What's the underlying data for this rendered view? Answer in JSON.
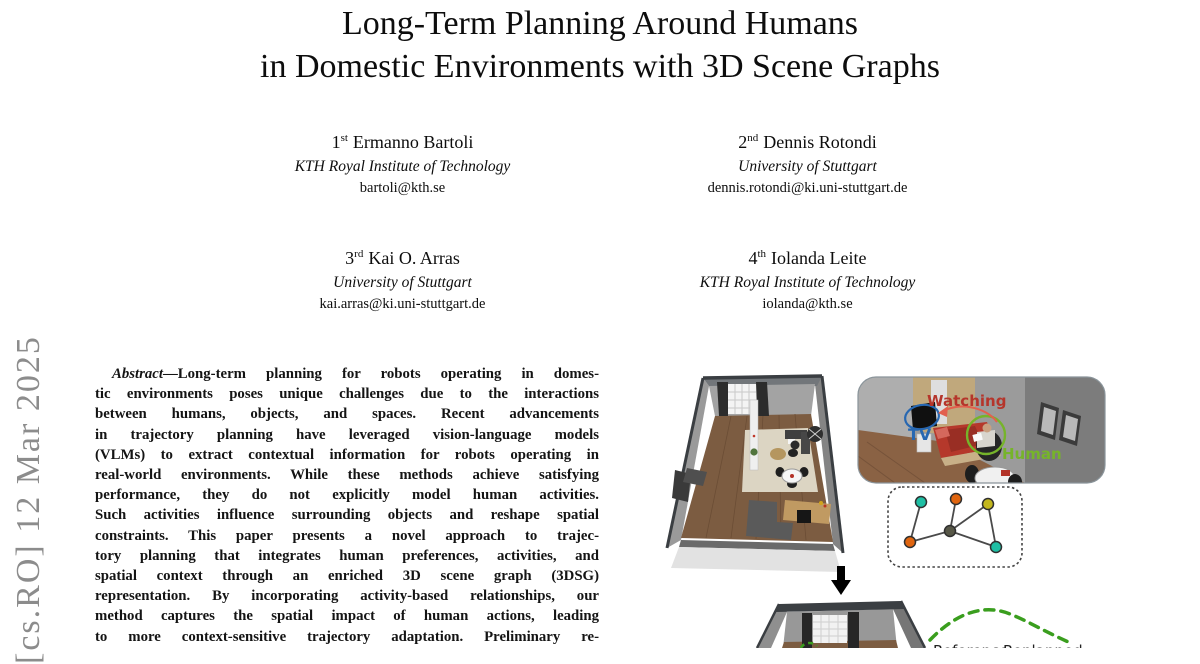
{
  "arxiv_stamp": {
    "text": "[cs.RO] 12 Mar 2025",
    "color": "#8c8c8c"
  },
  "title": {
    "line1": "Long-Term Planning Around Humans",
    "line2": "in Domestic Environments with 3D Scene Graphs"
  },
  "authors": [
    {
      "ordinal": "1",
      "suffix": "st",
      "name": "Ermanno Bartoli",
      "affiliation": "KTH Royal Institute of Technology",
      "email": "bartoli@kth.se"
    },
    {
      "ordinal": "2",
      "suffix": "nd",
      "name": "Dennis Rotondi",
      "affiliation": "University of Stuttgart",
      "email": "dennis.rotondi@ki.uni-stuttgart.de"
    },
    {
      "ordinal": "3",
      "suffix": "rd",
      "name": "Kai O. Arras",
      "affiliation": "University of Stuttgart",
      "email": "kai.arras@ki.uni-stuttgart.de"
    },
    {
      "ordinal": "4",
      "suffix": "th",
      "name": "Iolanda Leite",
      "affiliation": "KTH Royal Institute of Technology",
      "email": "iolanda@kth.se"
    }
  ],
  "abstract": {
    "label": "Abstract",
    "first_line_rest": "—Long-term planning for robots operating in domes-",
    "lines": [
      "tic environments poses unique challenges due to the interactions",
      "between humans, objects, and spaces. Recent advancements",
      "in trajectory planning have leveraged vision-language models",
      "(VLMs) to extract contextual information for robots operating in",
      "real-world environments. While these methods achieve satisfying",
      "performance, they do not explicitly model human activities.",
      "Such activities influence surrounding objects and reshape spatial",
      "constraints. This paper presents a novel approach to trajec-",
      "tory planning that integrates human preferences, activities, and",
      "spatial context through an enriched 3D scene graph (3DSG)",
      "representation. By incorporating activity-based relationships, our",
      "method captures the spatial impact of human actions, leading",
      "to more context-sensitive trajectory adaptation. Preliminary re-",
      "sults demonstrate the effectiveness of our method in a simulated"
    ]
  },
  "figure": {
    "labels": {
      "watching": "Watching",
      "tv": "TV",
      "human": "Human",
      "reference": "Reference",
      "replanned": "Replanned"
    },
    "colors": {
      "watching_red": "#b5352b",
      "arrow_red": "#e2604e",
      "tv_blue": "#2767b1",
      "human_green": "#76b42a",
      "path_green": "#3a9e1e",
      "node_teal": "#1fbfa4",
      "node_orange": "#e0650f",
      "node_yellow": "#c3b71e",
      "node_dark": "#575747",
      "path_label_dark": "#222222"
    }
  }
}
